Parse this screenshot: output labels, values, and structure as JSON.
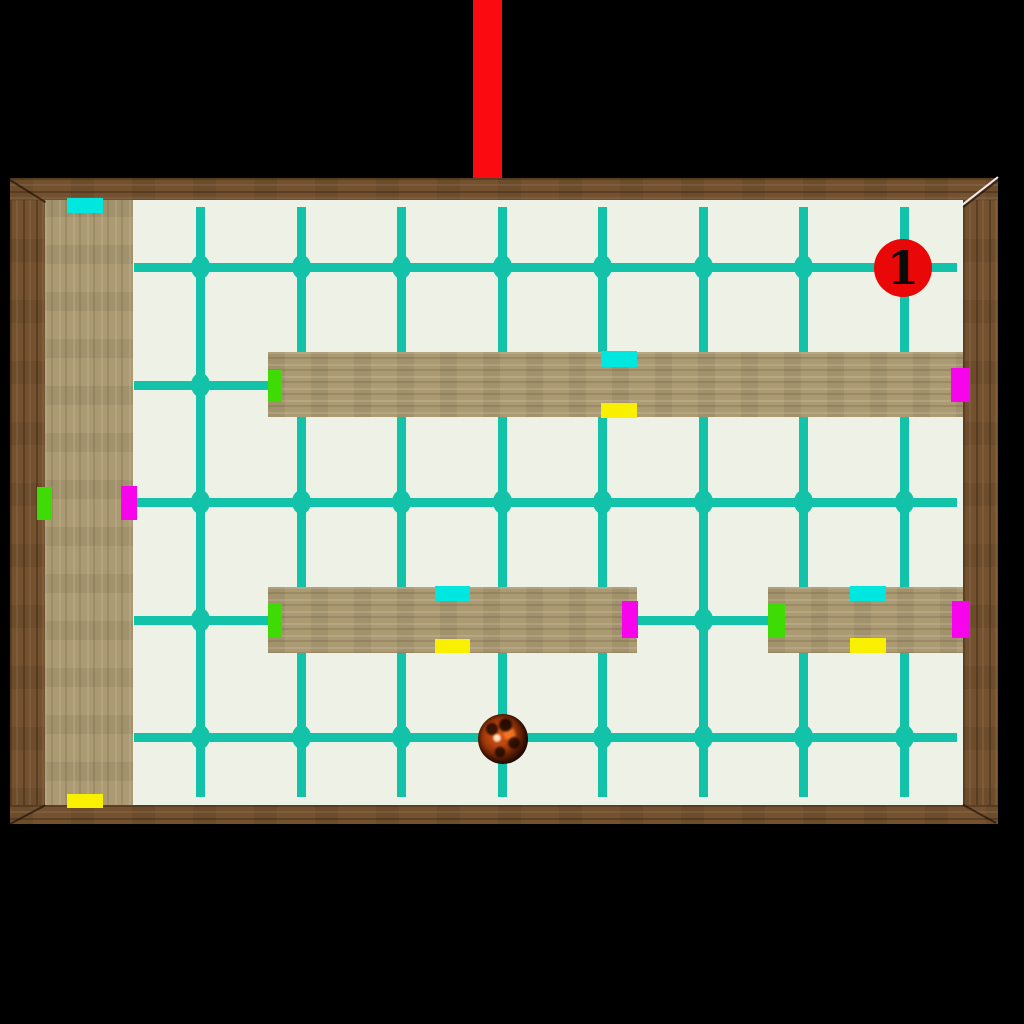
{
  "scene": {
    "width": 1024,
    "height": 1024,
    "background_color": "#000000"
  },
  "pendulum": {
    "x": 473,
    "y": 0,
    "w": 29,
    "h": 181,
    "color": "#fb0a0f"
  },
  "board": {
    "outer": {
      "x": 10,
      "y": 178,
      "w": 988,
      "h": 646
    },
    "frame": {
      "top": 22,
      "bottom": 19,
      "left": 35,
      "right": 35
    },
    "frame_color": "#74512f",
    "floor_color": "#edf1e6",
    "wall_color": "#ab9a72"
  },
  "grid": {
    "color": "#12c3aa",
    "line_thickness": 9,
    "vertical_x": [
      200,
      301,
      401,
      502,
      602,
      703,
      803,
      904
    ],
    "vertical_span": [
      207,
      797
    ],
    "horizontal_y": [
      267,
      385,
      502,
      620,
      737
    ],
    "horizontal_span": [
      134,
      957
    ],
    "dot_w": 19,
    "dot_h": 24
  },
  "bumper_colors": {
    "north": "#00e7e0",
    "south": "#f9f000",
    "west": "#3edc04",
    "east": "#f804ec"
  },
  "walls": [
    {
      "id": "left-wall",
      "x": 45,
      "y": 198,
      "w": 88,
      "h": 608,
      "grain": "v",
      "markers": [
        {
          "dir": "north",
          "x": 67,
          "y": 198,
          "w": 36,
          "h": 15
        },
        {
          "dir": "south",
          "x": 67,
          "y": 794,
          "w": 36,
          "h": 14
        },
        {
          "dir": "west",
          "x": 37,
          "y": 487,
          "w": 15,
          "h": 33
        },
        {
          "dir": "east",
          "x": 121,
          "y": 486,
          "w": 16,
          "h": 34
        }
      ]
    },
    {
      "id": "upper-bar",
      "x": 268,
      "y": 352,
      "w": 695,
      "h": 65,
      "grain": "h",
      "markers": [
        {
          "dir": "west",
          "x": 268,
          "y": 370,
          "w": 14,
          "h": 32
        },
        {
          "dir": "east",
          "x": 951,
          "y": 368,
          "w": 19,
          "h": 34
        },
        {
          "dir": "north",
          "x": 601,
          "y": 351,
          "w": 36,
          "h": 16
        },
        {
          "dir": "south",
          "x": 601,
          "y": 403,
          "w": 36,
          "h": 15
        }
      ]
    },
    {
      "id": "middle-bar",
      "x": 268,
      "y": 587,
      "w": 369,
      "h": 66,
      "grain": "h",
      "markers": [
        {
          "dir": "west",
          "x": 268,
          "y": 603,
          "w": 14,
          "h": 34
        },
        {
          "dir": "east",
          "x": 622,
          "y": 601,
          "w": 16,
          "h": 37
        },
        {
          "dir": "north",
          "x": 435,
          "y": 586,
          "w": 35,
          "h": 15
        },
        {
          "dir": "south",
          "x": 435,
          "y": 639,
          "w": 35,
          "h": 14
        }
      ]
    },
    {
      "id": "right-bar",
      "x": 768,
      "y": 587,
      "w": 195,
      "h": 66,
      "grain": "h",
      "markers": [
        {
          "dir": "west",
          "x": 768,
          "y": 603,
          "w": 17,
          "h": 35
        },
        {
          "dir": "east",
          "x": 952,
          "y": 601,
          "w": 18,
          "h": 37
        },
        {
          "dir": "north",
          "x": 850,
          "y": 586,
          "w": 36,
          "h": 15
        },
        {
          "dir": "south",
          "x": 850,
          "y": 638,
          "w": 36,
          "h": 15
        }
      ]
    }
  ],
  "checkpoint": {
    "label": "1",
    "cx": 903,
    "cy": 268,
    "r": 29,
    "color": "#e90707",
    "text_color": "#0a0a0a"
  },
  "ball": {
    "cx": 503,
    "cy": 739,
    "r": 25,
    "base_color": "#b8440e"
  }
}
